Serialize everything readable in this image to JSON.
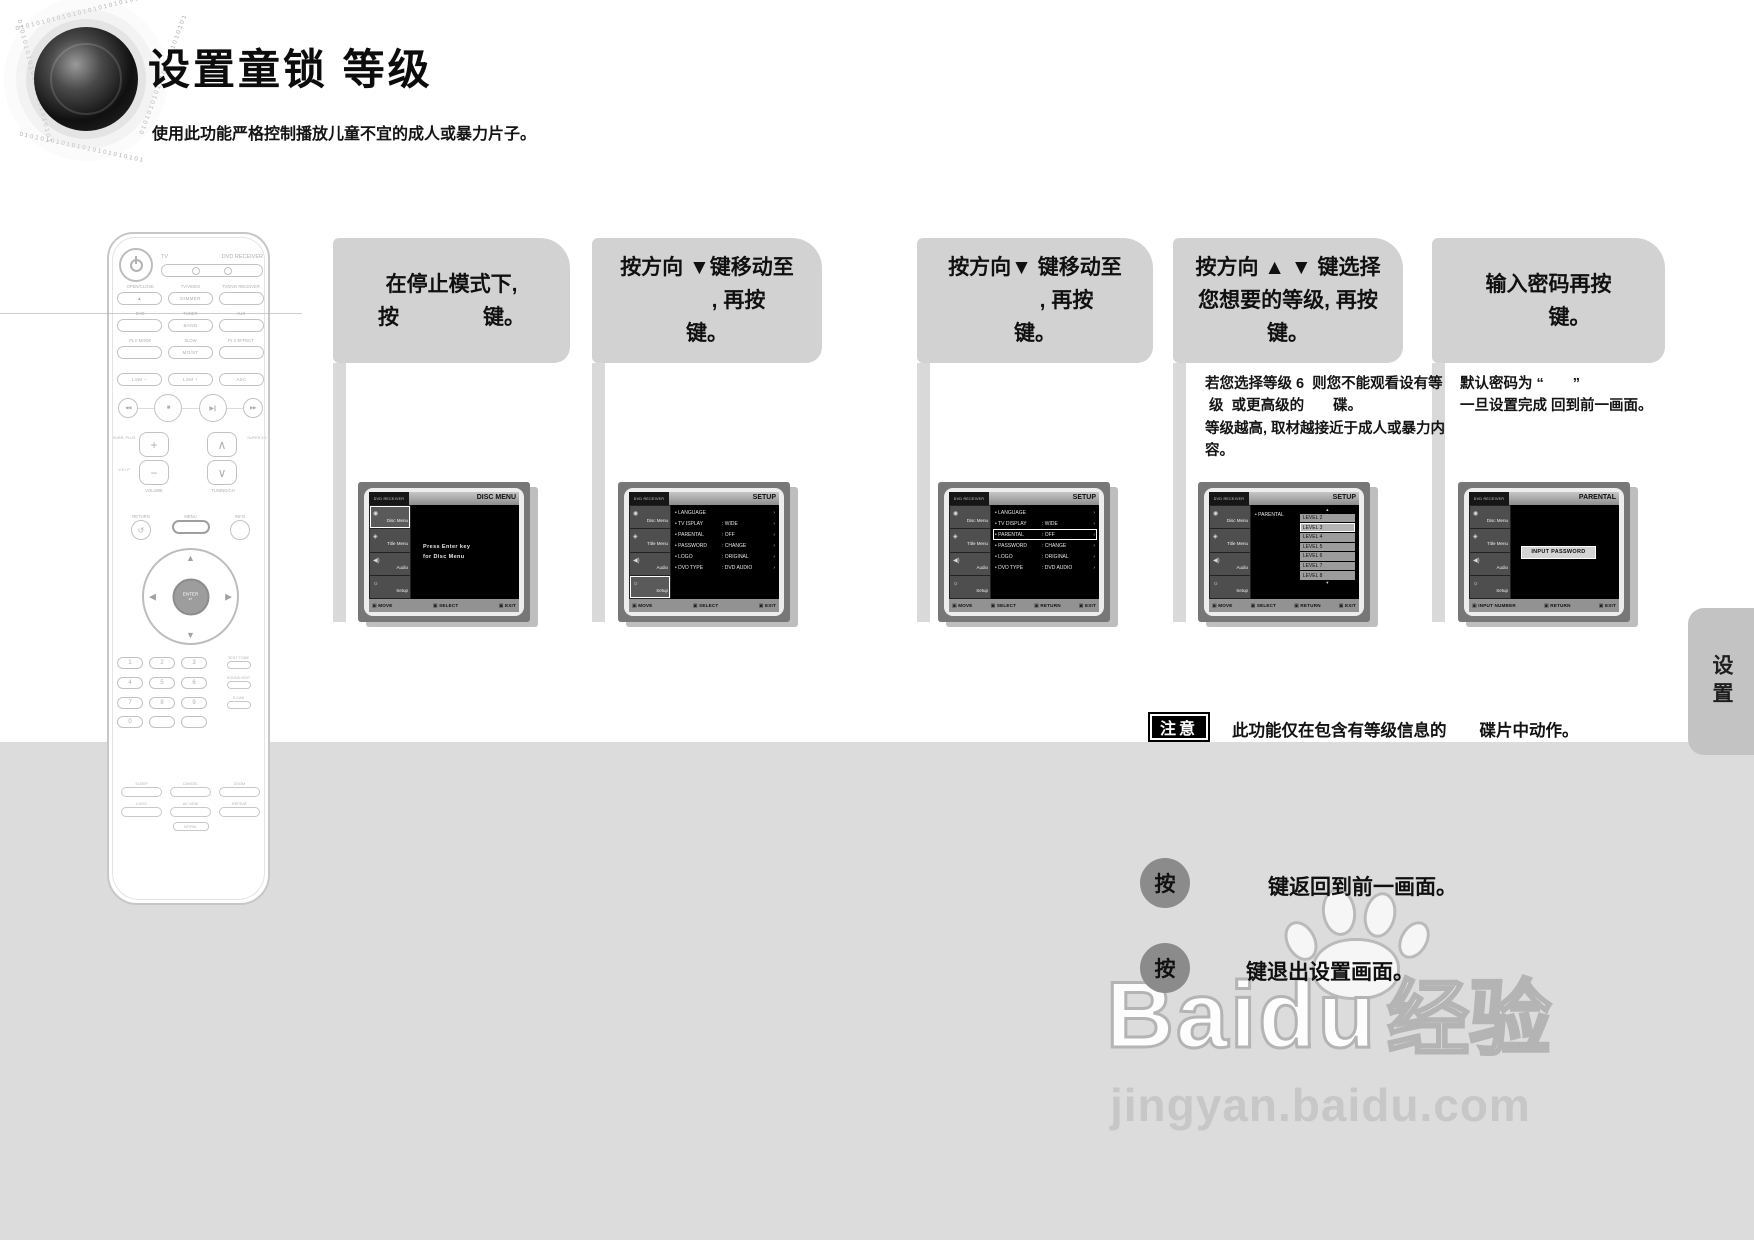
{
  "page": {
    "title": "设置童锁 等级",
    "subtitle": "使用此功能严格控制播放儿童不宜的成人或暴力片子。",
    "side_tab": "设置",
    "binary": "010101010101010101010101"
  },
  "steps": [
    {
      "lines": [
        "在停止模式下,",
        "按　　　　键。"
      ]
    },
    {
      "lines": [
        "按方向 ▼键移动至",
        "　　　, 再按",
        "键。"
      ]
    },
    {
      "lines": [
        "按方向▼ 键移动至",
        "　　　, 再按",
        "键。"
      ]
    },
    {
      "lines": [
        "按方向 ▲ ▼ 键选择",
        "您想要的等级, 再按",
        "键。"
      ],
      "note": [
        "若您选择等级 6  则您不能观看设有等",
        " 级  或更高级的　　碟。",
        "等级越高, 取材越接近于成人或暴力内",
        "容。"
      ]
    },
    {
      "lines": [
        "输入密码再按",
        "　　键。"
      ],
      "note": [
        "默认密码为 “　　”",
        "一旦设置完成 回到前一画面。"
      ]
    }
  ],
  "screens": [
    {
      "brand": "DVD RECEIVER",
      "title": "DISC MENU",
      "sidebar": [
        "Disc Menu",
        "Title Menu",
        "Audio",
        "Setup"
      ],
      "sidebar_selected": 0,
      "type": "message",
      "message": [
        "Press Enter key",
        "for Disc Menu"
      ],
      "footer": [
        "MOVE",
        "SELECT",
        "EXIT"
      ]
    },
    {
      "brand": "DVD RECEIVER",
      "title": "SETUP",
      "sidebar": [
        "Disc Menu",
        "Title Menu",
        "Audio",
        "Setup"
      ],
      "sidebar_selected": 3,
      "type": "menu",
      "highlight": -1,
      "menu": [
        {
          "label": "LANGUAGE",
          "value": ""
        },
        {
          "label": "TV ISPLAY",
          "value": "WIDE"
        },
        {
          "label": "PARENTAL",
          "value": "OFF"
        },
        {
          "label": "PASSWORD",
          "value": "CHANGE"
        },
        {
          "label": "LOGO",
          "value": "ORIGINAL"
        },
        {
          "label": "DVD TYPE",
          "value": "DVD AUDIO"
        }
      ],
      "footer": [
        "MOVE",
        "SELECT",
        "EXIT"
      ]
    },
    {
      "brand": "DVD RECEIVER",
      "title": "SETUP",
      "sidebar": [
        "Disc Menu",
        "Title Menu",
        "Audio",
        "Setup"
      ],
      "sidebar_selected": -1,
      "type": "menu",
      "highlight": 2,
      "menu": [
        {
          "label": "LANGUAGE",
          "value": ""
        },
        {
          "label": "TV DISPLAY",
          "value": "WIDE"
        },
        {
          "label": "PARENTAL",
          "value": "OFF"
        },
        {
          "label": "PASSWORD",
          "value": "CHANGE"
        },
        {
          "label": "LOGO",
          "value": "ORIGINAL"
        },
        {
          "label": "DVD TYPE",
          "value": "DVD AUDIO"
        }
      ],
      "footer": [
        "MOVE",
        "SELECT",
        "RETURN",
        "EXIT"
      ]
    },
    {
      "brand": "DVD RECEIVER",
      "title": "SETUP",
      "sidebar": [
        "Disc Menu",
        "Title Menu",
        "Audio",
        "Setup"
      ],
      "sidebar_selected": -1,
      "type": "levels",
      "parental_label": "PARENTAL",
      "levels": [
        "LEVEL 2",
        "LEVEL 3",
        "LEVEL 4",
        "LEVEL 5",
        "LEVEL 6",
        "LEVEL 7",
        "LEVEL 8"
      ],
      "selected_level": 1,
      "footer": [
        "MOVE",
        "SELECT",
        "RETURN",
        "EXIT"
      ]
    },
    {
      "brand": "DVD RECEIVER",
      "title": "PARENTAL",
      "sidebar": [
        "Disc Menu",
        "Title Menu",
        "Audio",
        "Setup"
      ],
      "sidebar_selected": -1,
      "type": "password",
      "password_box": "INPUT PASSWORD",
      "footer": [
        "INPUT NUMBER",
        "RETURN",
        "EXIT"
      ]
    }
  ],
  "note": {
    "badge": "注意",
    "text": "此功能仅在包含有等级信息的　　碟片中动作。"
  },
  "actions": [
    {
      "button": "按",
      "text": "键返回到前一画面。"
    },
    {
      "button": "按",
      "text": "键退出设置画面。"
    }
  ],
  "watermark": {
    "brand": "Baidu",
    "brand_cn": "经验",
    "url": "jingyan.baidu.com"
  },
  "remote": {
    "mode_labels": [
      "TV",
      "DVD RECEIVER"
    ],
    "rows": [
      {
        "labels": [
          "OPEN/CLOSE",
          "TV/VIDEO",
          "TV/DVD RECEIVER"
        ],
        "pills": [
          "▲",
          "DIMMER",
          ""
        ]
      },
      {
        "labels": [
          "DVD",
          "TUNER",
          "AUX"
        ],
        "pills": [
          "",
          "BAND",
          ""
        ]
      },
      {
        "labels": [
          "PL II MODE",
          "SLOW",
          "PL II EFFECT"
        ],
        "pills": [
          "",
          "MO/ST",
          ""
        ]
      },
      {
        "labels": [
          "",
          "",
          ""
        ],
        "pills": [
          "LSM −",
          "LSM +",
          "ASC"
        ]
      }
    ],
    "volume_label": "VOLUME",
    "tuning_label": "TUNING/CH",
    "side_labels": [
      "SURR. PLUS",
      "V.S.I.P",
      "SUPER 5.1"
    ],
    "mid_buttons": [
      "RETURN",
      "MENU",
      "INFO"
    ],
    "enter_label": "ENTER",
    "digits": [
      "1",
      "2",
      "3",
      "4",
      "5",
      "6",
      "7",
      "8",
      "9",
      "0"
    ],
    "digit_side_labels": [
      "TEST TONE",
      "SOUND EDIT",
      "S.CAN"
    ],
    "bottom_rows": [
      [
        "SLEEP",
        "CANCEL",
        "ZOOM"
      ],
      [
        "LOGO",
        "AV VIEW",
        "REPEAT"
      ]
    ],
    "bottom_tag": "NT/PAL"
  },
  "icons": {
    "prev": "◀◀",
    "stop": "■",
    "play_pause": "▶∥",
    "next": "▶▶",
    "up": "▲",
    "down": "▼",
    "left": "◀",
    "right": "▶",
    "return": "↺",
    "enter_glyph": "↵",
    "vol_up": "+",
    "vol_down": "−",
    "tun_up": "∧",
    "tun_down": "∨",
    "disc_menu": "◉",
    "title_menu": "◈",
    "audio": "◀)",
    "setup": "☼",
    "footer_chip": "▣",
    "menu_arrow": "›"
  },
  "colors": {
    "step_box": "#d2d2d2",
    "bottom_panel": "#dcdcdc",
    "note_badge_bg": "#000000",
    "screen_frame": "#777777",
    "action_circle": "#8b8b8b"
  }
}
